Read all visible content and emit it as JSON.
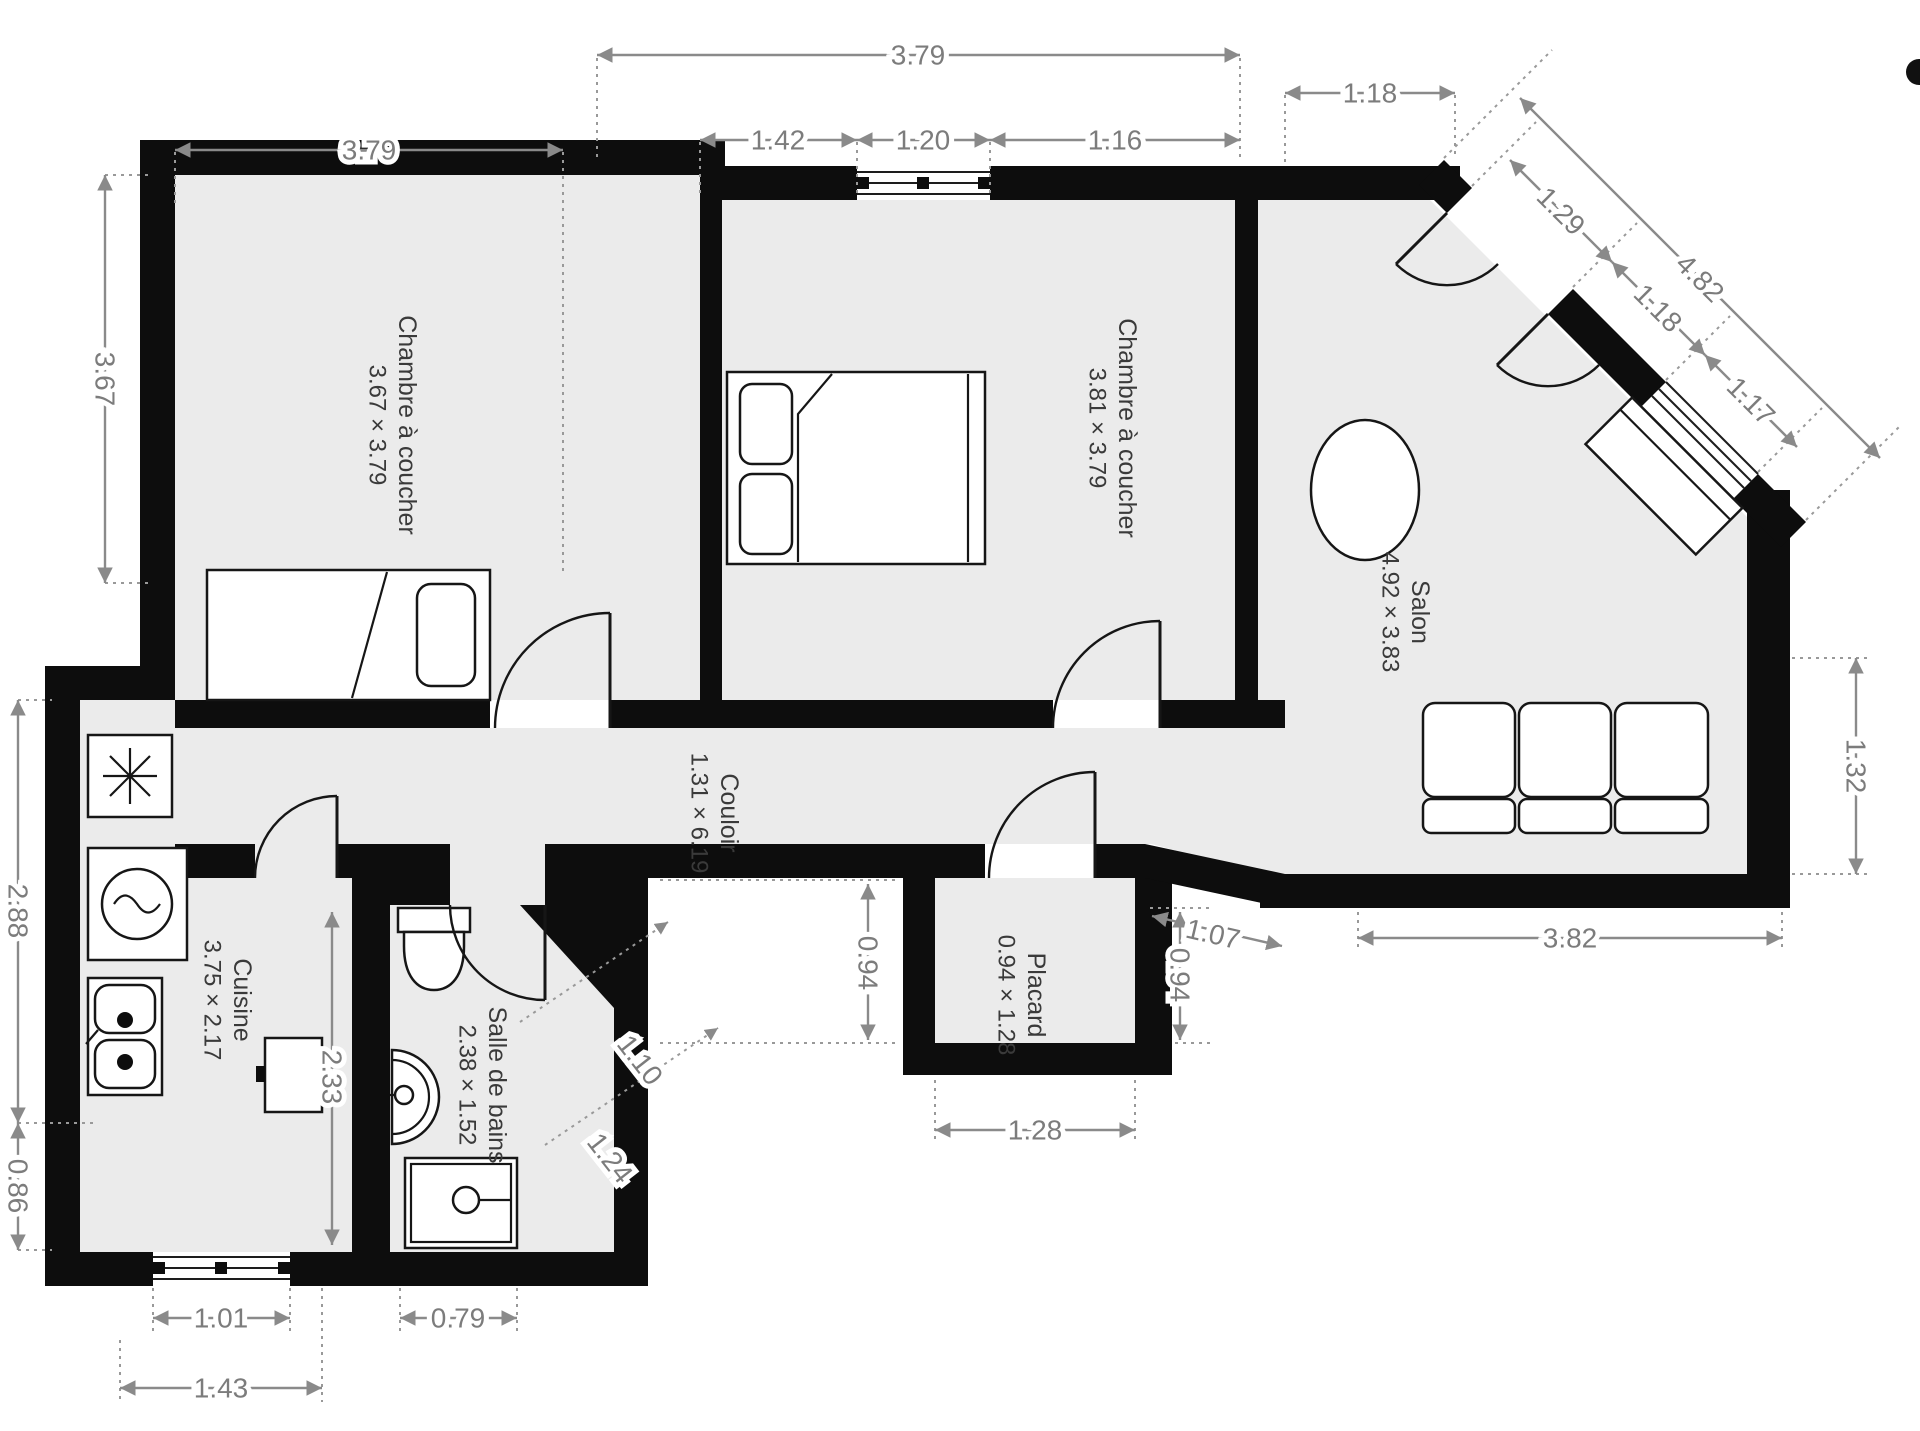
{
  "rooms": {
    "bedroom1": {
      "name": "Chambre à coucher",
      "dims": "3.67 × 3.79"
    },
    "bedroom2": {
      "name": "Chambre à coucher",
      "dims": "3.81 × 3.79"
    },
    "salon": {
      "name": "Salon",
      "dims": "4.92 × 3.83"
    },
    "couloir": {
      "name": "Couloir",
      "dims": "1.31 × 6.19"
    },
    "cuisine": {
      "name": "Cuisine",
      "dims": "3.75 × 2.17"
    },
    "bathroom": {
      "name": "Salle de bains",
      "dims": "2.38 × 1.52"
    },
    "placard": {
      "name": "Placard",
      "dims": "0.94 × 1.28"
    }
  },
  "dimensions": {
    "bedroom1_width": "3.79",
    "bedroom1_height": "3.67",
    "bedroom2_width": "3.79",
    "bedroom2_seg_left": "1.42",
    "bedroom2_window": "1.20",
    "bedroom2_seg_right": "1.16",
    "salon_top": "1.18",
    "salon_diag_total": "4.82",
    "salon_diag_door": "1.29",
    "salon_diag_wall": "1.18",
    "salon_diag_window": "1.17",
    "salon_right": "1.32",
    "salon_bottom": "3.82",
    "kitchen_left_upper": "2.88",
    "kitchen_left_lower": "0.86",
    "kitchen_inner": "2.33",
    "kitchen_window": "1.01",
    "kitchen_bottom": "1.43",
    "bath_shower": "0.79",
    "bath_diag_inner": "1.10",
    "bath_diag_outer": "1.24",
    "hall_left_gap": "0.94",
    "hall_right_gap": "0.94",
    "hall_diag": "1.07",
    "placard_width": "1.28"
  },
  "colors": {
    "wall": "#0d0d0d",
    "room_fill": "#ebebeb",
    "dimension": "#7c7c7c",
    "label": "#3a3a3a",
    "background": "#ffffff"
  }
}
